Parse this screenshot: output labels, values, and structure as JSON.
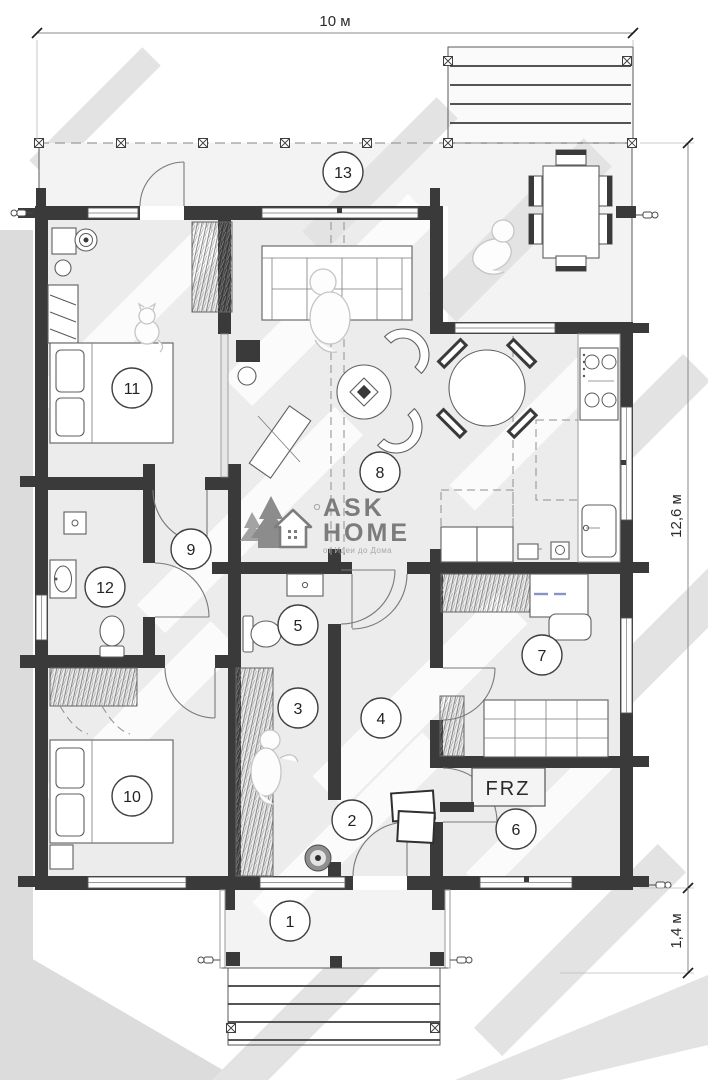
{
  "plan": {
    "dimensions": {
      "width_label": "10 м",
      "height_label": "12,6 м",
      "porch_label": "1,4 м"
    },
    "rooms": [
      {
        "number": "1"
      },
      {
        "number": "2"
      },
      {
        "number": "3"
      },
      {
        "number": "4"
      },
      {
        "number": "5"
      },
      {
        "number": "6"
      },
      {
        "number": "7"
      },
      {
        "number": "8"
      },
      {
        "number": "9"
      },
      {
        "number": "10"
      },
      {
        "number": "11"
      },
      {
        "number": "12"
      },
      {
        "number": "13"
      }
    ],
    "labels": {
      "freezer": "FRZ"
    },
    "logo": {
      "line1": "ASK",
      "line2": "HOME",
      "tagline": "от Идеи до Дома"
    },
    "colors": {
      "wall": "#3a3a3a",
      "accent_blue": "#8a93c4"
    }
  }
}
